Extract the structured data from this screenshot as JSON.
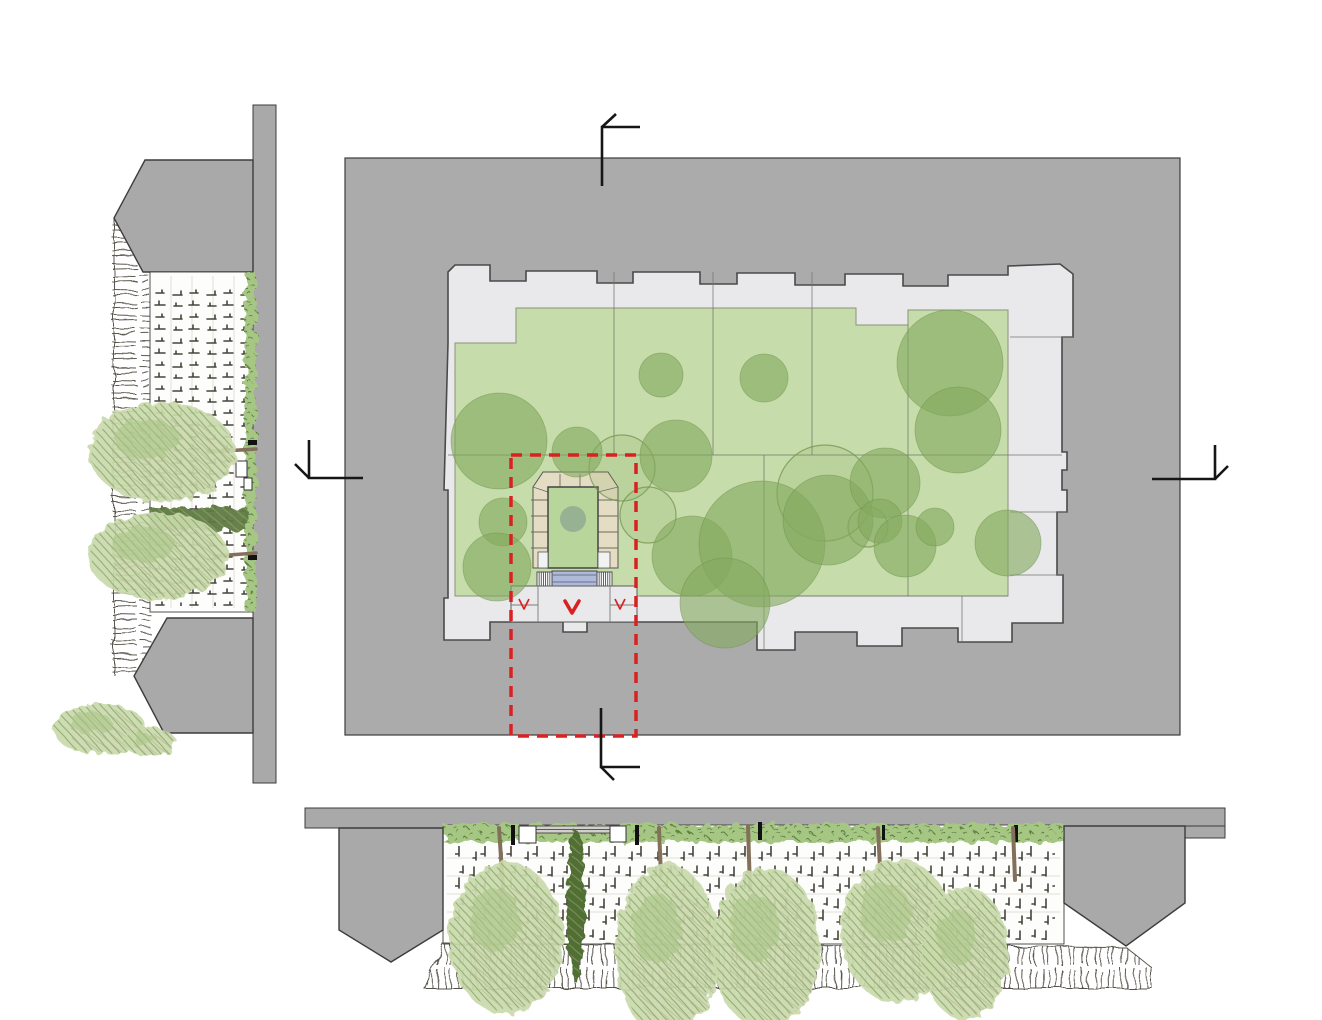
{
  "palette": {
    "block_gray": "#ababab",
    "elev_gray": "#a9a9a9",
    "outline_dark": "#3c3c3c",
    "footprint_fill": "#e9e9ec",
    "footprint_stroke": "#4a4a4a",
    "division": "#70786a",
    "lawn": "#c6dcaa",
    "tree_fill": "#84a95f",
    "tree_stroke": "#6d9048",
    "entrance_paving": "#e4ddc3",
    "entrance_lawn": "#b8d59c",
    "entrance_circle": "#8fab90",
    "ramp": "#aebad7",
    "stair_line": "#4f4f4f",
    "plaza": "#e9e9ec",
    "red": "#d92121",
    "marker_black": "#161616",
    "wall_white": "#fdfdfb",
    "wall_stroke": "#3f3f3f",
    "faint": "#e2dfd7",
    "marks": "#45453d",
    "hedge_light": "#a6c783",
    "hedge_mid": "#85aa60",
    "hedge_dark": "#5c7b3f",
    "cypress": "#4f7030",
    "trunk": "#83705b",
    "foliage_base": "#c9d9ab",
    "foliage_mid": "#aac486",
    "foliage_dark": "#89a766",
    "foliage_brown": "#b3a28d",
    "hatch": "#5a564e"
  },
  "canvas": {
    "w": 1322,
    "h": 1020
  },
  "plan": {
    "block": {
      "x": 345,
      "y": 158,
      "w": 835,
      "h": 577
    },
    "footprint_path": "M448,343 L448,272 L455,265 L490,265 L490,281 L526,281 L526,271 L597,271 L597,283 L633,283 L633,272 L700,272 L700,284 L737,284 L737,273 L795,273 L795,285 L845,285 L845,274 L903,274 L903,286 L948,286 L948,275 L1008,275 L1008,266 L1060,264 L1073,274 L1073,337 L1062,337 L1062,452 L1067,452 L1067,470 L1062,470 L1062,490 L1067,490 L1067,512 L1057,512 L1057,575 L1063,575 L1063,623 L1012,623 L1012,642 L958,642 L958,628 L902,628 L902,646 L857,646 L857,632 L795,632 L795,650 L757,650 L757,622 L587,622 L587,632 L563,632 L563,622 L490,622 L490,640 L444,640 L444,598 L448,598 L448,490 L444,490 Z",
    "courtyard_path": "M455,343 L516,343 L516,308 L856,308 L856,325 L908,325 L908,310 L1008,310 L1008,596 L455,596 Z",
    "division_lines": [
      [
        614,
        272,
        614,
        455
      ],
      [
        713,
        272,
        713,
        455
      ],
      [
        812,
        272,
        812,
        455
      ],
      [
        908,
        325,
        908,
        596
      ],
      [
        764,
        455,
        764,
        650
      ],
      [
        448,
        455,
        1062,
        455
      ],
      [
        640,
        596,
        1008,
        596
      ],
      [
        1010,
        337,
        1073,
        337
      ],
      [
        1010,
        512,
        1067,
        512
      ],
      [
        1010,
        575,
        1063,
        575
      ],
      [
        962,
        596,
        962,
        642
      ]
    ],
    "trees_filled": [
      [
        499,
        441,
        48
      ],
      [
        577,
        452,
        25
      ],
      [
        661,
        375,
        22
      ],
      [
        764,
        378,
        24
      ],
      [
        950,
        363,
        53
      ],
      [
        958,
        430,
        43
      ],
      [
        676,
        456,
        36
      ],
      [
        692,
        556,
        40
      ],
      [
        762,
        544,
        63
      ],
      [
        725,
        603,
        45
      ],
      [
        828,
        520,
        45
      ],
      [
        885,
        483,
        35
      ],
      [
        880,
        521,
        22
      ],
      [
        905,
        546,
        31
      ],
      [
        935,
        527,
        19
      ],
      [
        503,
        522,
        24
      ],
      [
        497,
        567,
        34
      ],
      [
        1008,
        543,
        33
      ]
    ],
    "trees_outlined": [
      [
        622,
        468,
        33
      ],
      [
        825,
        493,
        48
      ],
      [
        868,
        527,
        20
      ],
      [
        648,
        515,
        28
      ]
    ],
    "entrance": {
      "u_path": "M533,487 L543,472 L608,472 L618,487 L618,568 L598,568 L598,487 L548,487 L548,568 L533,568 Z",
      "u_ticks": [
        [
          531,
          500,
          548,
          500
        ],
        [
          531,
          516,
          548,
          516
        ],
        [
          531,
          532,
          548,
          532
        ],
        [
          531,
          548,
          548,
          548
        ],
        [
          598,
          500,
          618,
          500
        ],
        [
          598,
          516,
          618,
          516
        ],
        [
          598,
          532,
          618,
          532
        ],
        [
          598,
          548,
          618,
          548
        ],
        [
          560,
          474,
          560,
          487
        ],
        [
          580,
          474,
          580,
          487
        ],
        [
          533,
          487,
          548,
          492
        ],
        [
          618,
          487,
          598,
          492
        ]
      ],
      "lawn": {
        "x": 548,
        "y": 487,
        "w": 50,
        "h": 81
      },
      "circle": {
        "cx": 573,
        "cy": 519,
        "r": 13
      },
      "landings": [
        {
          "x": 538,
          "y": 552,
          "w": 10,
          "h": 16
        },
        {
          "x": 598,
          "y": 552,
          "w": 12,
          "h": 16
        }
      ],
      "stairs": [
        {
          "x": 537,
          "y": 572,
          "w": 15,
          "h": 14
        },
        {
          "x": 597,
          "y": 572,
          "w": 15,
          "h": 14
        }
      ],
      "ramp": {
        "x": 552,
        "y": 571,
        "w": 45,
        "h": 15
      },
      "plaza": {
        "x": 511,
        "y": 586,
        "w": 126,
        "h": 36
      },
      "plaza_lines": [
        [
          538,
          586,
          538,
          622
        ],
        [
          610,
          586,
          610,
          622
        ],
        [
          511,
          605,
          538,
          605
        ],
        [
          610,
          605,
          636,
          605
        ]
      ]
    },
    "red_box": {
      "x": 511,
      "y": 455,
      "w": 125,
      "h": 281,
      "dash": "11 8",
      "width": 3.5
    },
    "arrow_bold": "M565,601 L572,613 L579,601",
    "arrows_outline": [
      "M519,599 L524,609 L529,599",
      "M615,599 L620,609 L625,599"
    ],
    "markers": [
      {
        "name": "section-marker-top",
        "line": "M602,186 L602,127 L640,127",
        "tick": "M602,127 L616,114"
      },
      {
        "name": "section-marker-left",
        "line": "M309,440 L309,478 L363,478",
        "tick": "M309,478 L295,464"
      },
      {
        "name": "section-marker-right",
        "line": "M1152,479 L1215,479 L1215,445",
        "tick": "M1215,479 L1228,466"
      },
      {
        "name": "section-marker-bottom",
        "line": "M601,708 L601,767 L640,767",
        "tick": "M601,767 L614,780"
      }
    ]
  },
  "left_elevation": {
    "bar": {
      "x": 253,
      "y": 105,
      "w": 23,
      "h": 678
    },
    "top_mass": "M145,160 L253,160 L253,272 L143,272 L114,218 Z",
    "bottom_mass": "M167,618 L253,618 L253,733 L164,733 L134,676 Z",
    "hatch_strip": {
      "x": 112,
      "y": 218,
      "w": 38,
      "h": 457
    },
    "wall": {
      "x": 150,
      "y": 272,
      "w": 103,
      "h": 340
    },
    "faint_lines": [
      [
        171,
        276,
        171,
        608
      ],
      [
        192,
        276,
        192,
        608
      ],
      [
        213,
        276,
        213,
        608
      ],
      [
        234,
        276,
        234,
        608
      ]
    ],
    "marks_rect": {
      "x": 152,
      "y": 284,
      "w": 96,
      "h": 322
    },
    "hedge_strip": {
      "x": 245,
      "y": 272,
      "w": 11,
      "h": 340
    },
    "hedge_band": {
      "x": 150,
      "y": 508,
      "w": 98,
      "h": 22
    },
    "boxes": [
      {
        "x": 236,
        "y": 461,
        "w": 11,
        "h": 16
      },
      {
        "x": 244,
        "y": 478,
        "w": 8,
        "h": 12
      }
    ],
    "ticks": [
      {
        "x": 248,
        "y": 440,
        "w": 9,
        "h": 5
      },
      {
        "x": 248,
        "y": 555,
        "w": 9,
        "h": 5
      }
    ],
    "trunks": [
      [
        256,
        449,
        208,
        452
      ],
      [
        256,
        553,
        215,
        556
      ]
    ],
    "canopies": [
      {
        "cx": 162,
        "cy": 452,
        "rx": 73,
        "ry": 50
      },
      {
        "cx": 158,
        "cy": 556,
        "rx": 70,
        "ry": 44
      }
    ],
    "bushes": [
      {
        "cx": 100,
        "cy": 729,
        "rx": 46,
        "ry": 26
      },
      {
        "cx": 150,
        "cy": 742,
        "rx": 26,
        "ry": 14
      }
    ]
  },
  "bottom_elevation": {
    "band": {
      "x": 305,
      "y": 808,
      "w": 920,
      "h": 20
    },
    "band_right": {
      "x": 1140,
      "y": 826,
      "w": 85,
      "h": 12
    },
    "left_mass": "M339,828 L443,828 L443,930 L391,962 L339,930 Z",
    "right_mass": "M1064,826 L1185,826 L1185,903 L1126,946 L1064,903 Z",
    "wall": {
      "x": 443,
      "y": 825,
      "w": 621,
      "h": 119
    },
    "faint_lines": [
      [
        447,
        858,
        1060,
        858
      ],
      [
        447,
        876,
        1060,
        876
      ],
      [
        447,
        894,
        1060,
        894
      ],
      [
        447,
        912,
        1060,
        912
      ]
    ],
    "marks_rect": {
      "x": 455,
      "y": 846,
      "w": 600,
      "h": 94
    },
    "hedge_strip": {
      "x": 443,
      "y": 824,
      "w": 621,
      "h": 18
    },
    "hatch_poly": "M443,944 L1126,947 L1152,968 L1152,988 L424,988 Z",
    "boxes": [
      {
        "x": 519,
        "y": 826,
        "w": 17,
        "h": 17
      },
      {
        "x": 610,
        "y": 826,
        "w": 16,
        "h": 16
      }
    ],
    "gray_strip": {
      "x": 536,
      "y": 826,
      "w": 74,
      "h": 7
    },
    "ticks": [
      {
        "x": 511,
        "y": 825,
        "w": 4,
        "h": 20
      },
      {
        "x": 635,
        "y": 825,
        "w": 4,
        "h": 20
      },
      {
        "x": 758,
        "y": 822,
        "w": 4,
        "h": 18
      },
      {
        "x": 882,
        "y": 825,
        "w": 3,
        "h": 15
      },
      {
        "x": 1014,
        "y": 825,
        "w": 4,
        "h": 17
      }
    ],
    "cypress": {
      "cx": 576,
      "cy": 906,
      "rx": 9,
      "ry": 76
    },
    "trunks": [
      [
        499,
        828,
        503,
        888
      ],
      [
        659,
        828,
        661,
        876
      ],
      [
        748,
        826,
        750,
        890
      ],
      [
        878,
        828,
        880,
        868
      ],
      [
        1013,
        828,
        1015,
        880
      ]
    ],
    "canopies": [
      {
        "cx": 506,
        "cy": 938,
        "rx": 57,
        "ry": 76
      },
      {
        "cx": 667,
        "cy": 950,
        "rx": 52,
        "ry": 86
      },
      {
        "cx": 766,
        "cy": 948,
        "rx": 55,
        "ry": 80
      },
      {
        "cx": 897,
        "cy": 931,
        "rx": 56,
        "ry": 72
      },
      {
        "cx": 965,
        "cy": 953,
        "rx": 44,
        "ry": 66
      }
    ]
  }
}
